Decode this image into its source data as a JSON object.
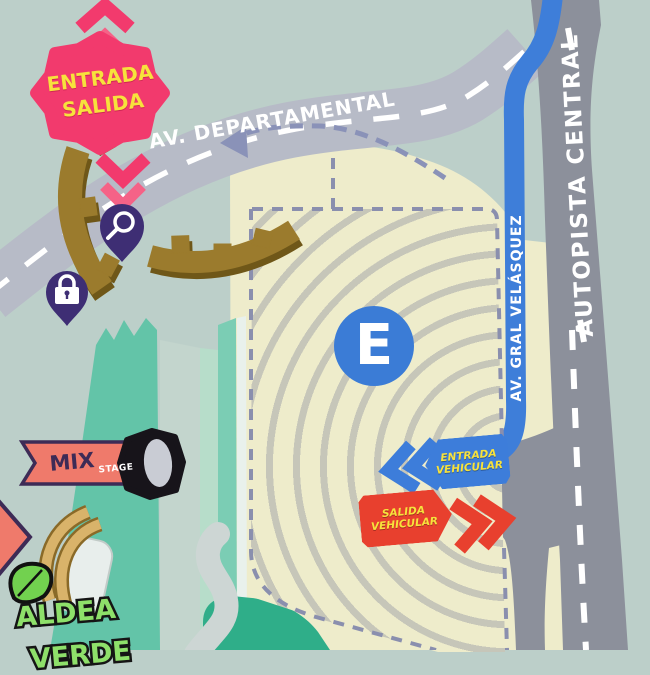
{
  "map": {
    "entrance_burst": {
      "line1": "ENTRADA",
      "line2": "SALIDA"
    },
    "roads": {
      "departamental": "AV. DEPARTAMENTAL",
      "autopista": "AUTOPISTA CENTRAL",
      "velasquez": "AV. GRAL VELÁSQUEZ"
    },
    "parking": {
      "symbol": "E"
    },
    "vehicle_entrance": {
      "line1": "ENTRADA",
      "line2": "VEHICULAR"
    },
    "vehicle_exit": {
      "line1": "SALIDA",
      "line2": "VEHICULAR"
    },
    "stage": {
      "name": "MIX",
      "label": "STAGE"
    },
    "green_village": {
      "line1": "ALDEA",
      "line2": "VERDE"
    },
    "icons": {
      "search_pin": "magnifier",
      "lock_pin": "padlock",
      "leaf": "leaf",
      "pedestrian_route": "dashed-arrow",
      "entry_chevrons": "double-chevron-left",
      "exit_chevrons": "double-chevron-right"
    },
    "colors": {
      "background": "#bccfc9",
      "road_light": "#b7bbc7",
      "road_dark": "#8c909b",
      "blue_road": "#3e7ed9",
      "parking_cream": "#eeeccb",
      "parking_stripe": "#c6c6b9",
      "boundary_dash": "#8a8fae",
      "venue_green": "#63c4a8",
      "pink": "#f23a6d",
      "yellow": "#f7e23c",
      "pin_purple": "#3e2e74",
      "gate_brown": "#9b7b2d",
      "exit_red": "#e8402e",
      "stage_coral": "#ef7a6b"
    }
  }
}
